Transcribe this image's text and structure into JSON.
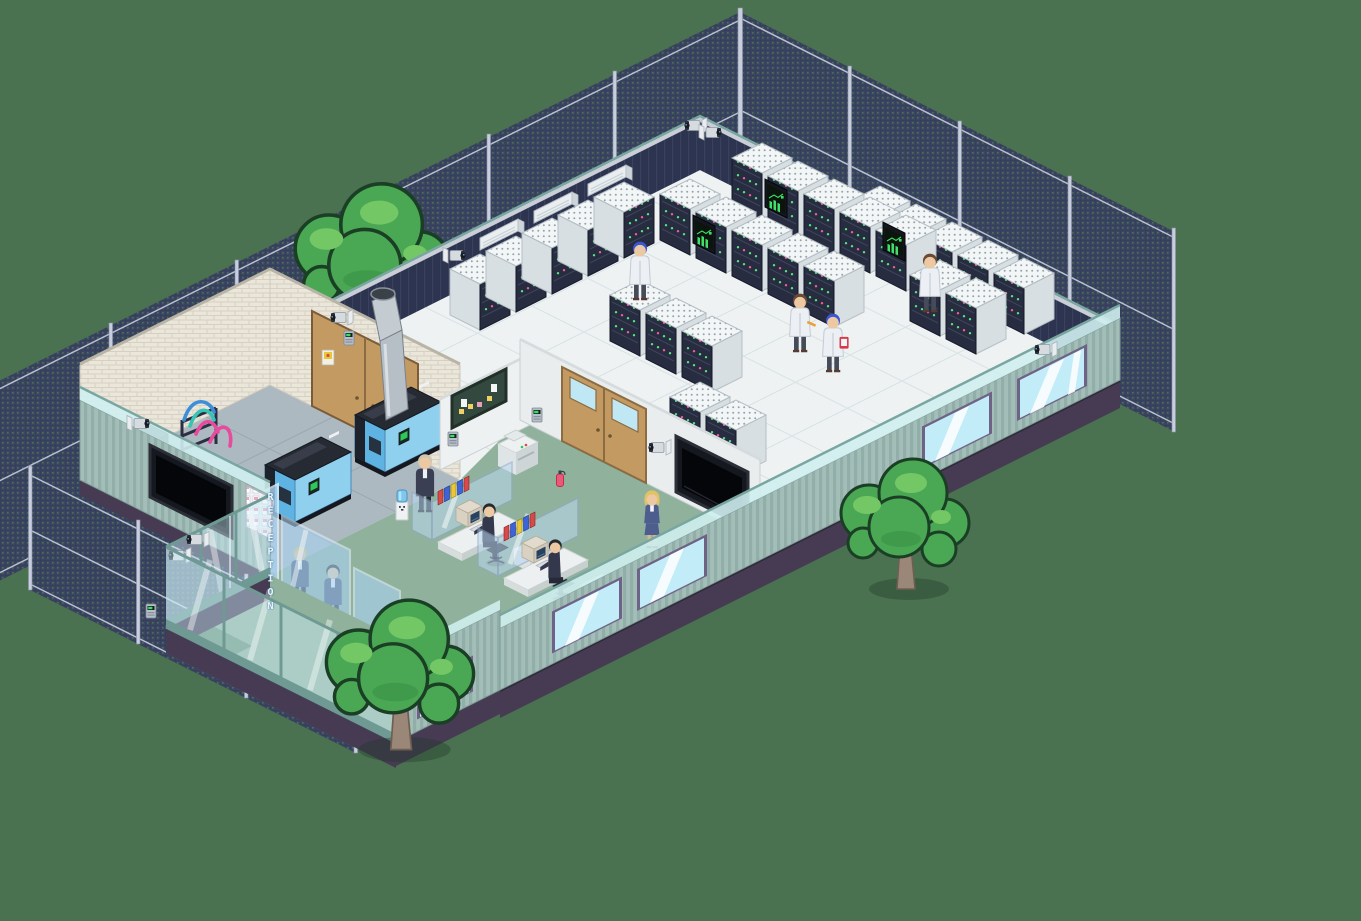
{
  "scene": {
    "description": "Isometric pixel-art data center campus: cutaway building with server hall, power room, office cubicles and reception lobby, surrounded by chain-link security fence and cartoon trees on a plain green field",
    "style": "isometric pixel art",
    "background_color": "#4a7150"
  },
  "reception": {
    "sign_label": "RECEPTION",
    "sign_orientation": "vertical letters on glass partition",
    "staff": [
      {
        "role": "receptionist",
        "hair": "blonde",
        "uniform": "blue suit"
      },
      {
        "role": "receptionist",
        "hair": "dark",
        "uniform": "blue suit"
      }
    ],
    "desk": "white counter with wooden front, laptop and side CRT terminal",
    "visitors_with_briefcases": 2
  },
  "lobby": {
    "wall_tv_count": 1,
    "poster_board": "grid of small visitor cards",
    "glass_entrance_doors": true,
    "keycard_panel": true,
    "water_cooler": true,
    "standing_visitor_count": 1,
    "floor": "green carpet with dark entry mat"
  },
  "office": {
    "cubicle_count": 2,
    "seated_workers": 2,
    "standing_manager": {
      "hair": "blonde",
      "outfit": "blue skirt suit"
    },
    "equipment": [
      "CRT computers",
      "office chairs",
      "binder shelves",
      "drawer cabinets",
      "photocopier",
      "fire extinguisher",
      "notice board with sticky notes",
      "keycard panels",
      "wall TV"
    ],
    "doors_to_server_room": "wooden double doors with windows"
  },
  "server_room": {
    "total_racks": 27,
    "rack_style": "white perforated tops, dark front panels",
    "led_colors": [
      "#54e47c",
      "#ef5f93"
    ],
    "status_monitor_count": 3,
    "status_monitor_screen": "green bar graph with trend line",
    "technicians": [
      {
        "coat": "white",
        "hair": "brown",
        "holding": "tool"
      },
      {
        "coat": "white",
        "hair": "blue",
        "holding": "red clipboard"
      },
      {
        "coat": "white",
        "hair": "blue"
      },
      {
        "coat": "white",
        "hair": "brown"
      }
    ],
    "wall_ac_unit_count": 3,
    "floor": "white raised tiles"
  },
  "power_room": {
    "generator_count": 2,
    "generator_colors": [
      "#5fb3e3",
      "#23262f"
    ],
    "exhaust_chimney": true,
    "cable_rack_cable_colors": [
      "#3a8fd8",
      "#35c4b5",
      "#e84a9e"
    ],
    "walls": "white brick",
    "doors": "wooden double doors with hazard sign",
    "keycard_panel": true
  },
  "security": {
    "perimeter": "chain-link fence with posts and rails",
    "camera_count": 11,
    "keycard_panel_count": 4,
    "wall_tv_count": 2
  },
  "exterior": {
    "tree_count": 3,
    "siding_color": "#9fbab4",
    "foundation_color": "#463b52",
    "window_glass_color": "#c2ecf7"
  },
  "palette": {
    "grass": "#4a7150",
    "fence_mesh": "#3b4462",
    "back_wall": "#2d3450",
    "rack_front": "#272c40",
    "led_green": "#54e47c",
    "led_pink": "#ef5f93",
    "screen_green": "#3fe06a",
    "carpet": "#90b29d",
    "wood_door": "#c49a63",
    "tree_leaf": "#4aa854"
  }
}
